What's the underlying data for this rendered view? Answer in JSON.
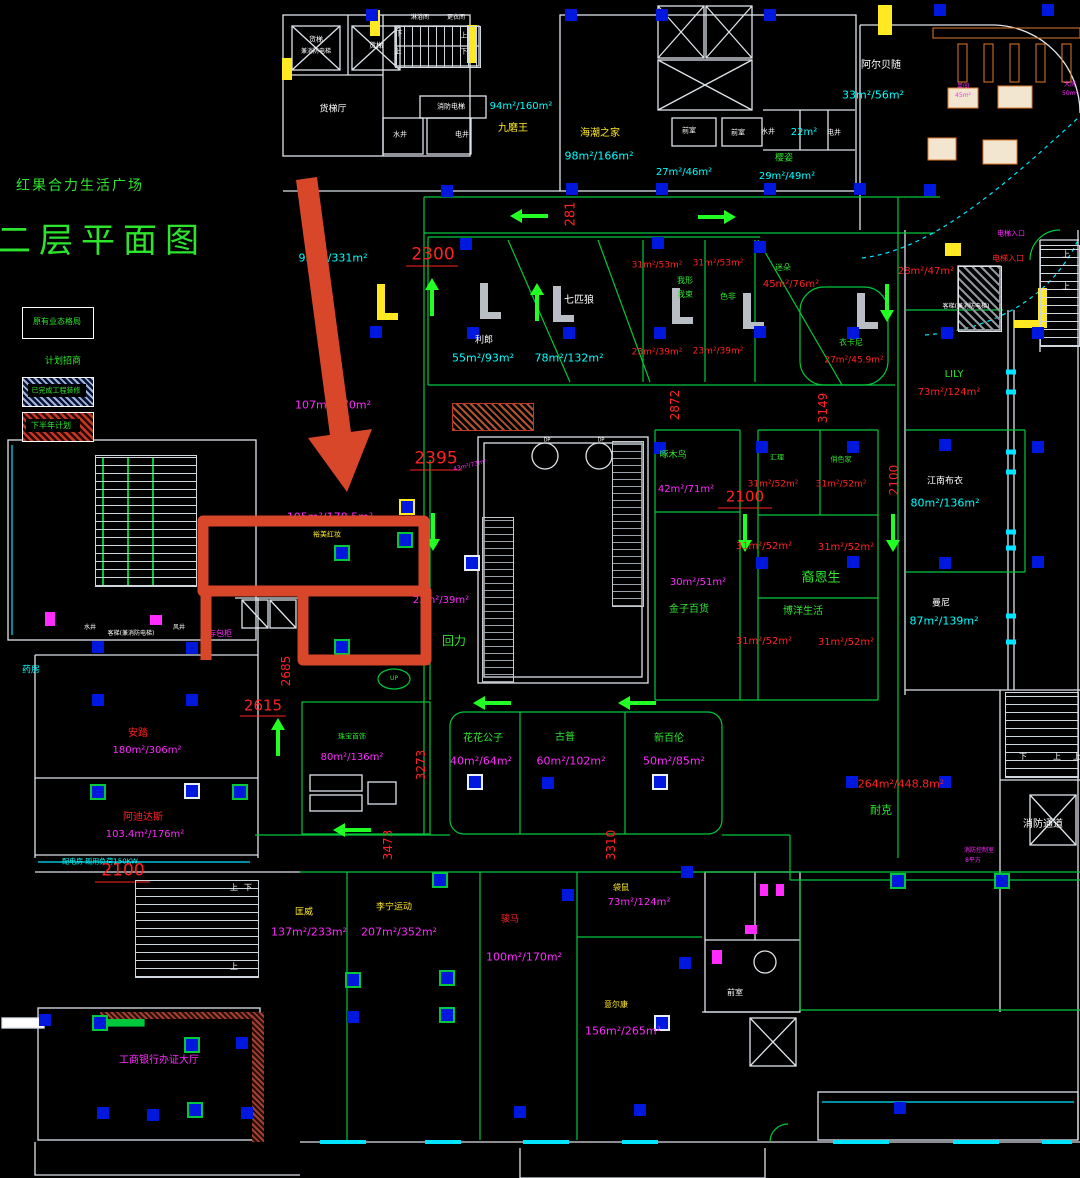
{
  "drawing": {
    "project_title": "红果合力生活广场",
    "sheet_title": "二层平面图"
  },
  "colors": {
    "g": "#2ee52e",
    "c": "#00ffff",
    "m": "#ff2bff",
    "r": "#ff2222",
    "y": "#ffe923",
    "w": "#ffffff",
    "o": "#e07a2e",
    "line_green": "#00c83c",
    "wall_white": "#dde4ea",
    "cyan_line": "#00e5ff",
    "blue_marker": "#0018dd",
    "annotation_red": "#d9472b",
    "legend_hatch_blue": "#9fb4dd",
    "legend_hatch_red": "#c23826"
  },
  "legend": {
    "existing_box_label": "原有业态格局",
    "note_label": "计划招商",
    "done_hatch_label": "已完成工程装修",
    "plan_hatch_label": "下半年计划"
  },
  "labels": [
    {
      "t": "红果合力生活广场",
      "x": 80,
      "y": 186,
      "c": "g",
      "s": 14,
      "ls": 2,
      "n": "project-title"
    },
    {
      "t": "二层平面图",
      "x": 102,
      "y": 241,
      "c": "g",
      "s": 34,
      "ls": 8,
      "n": "sheet-title"
    },
    {
      "t": "原有业态格局",
      "x": 57,
      "y": 322,
      "c": "g",
      "s": 8,
      "n": "legend-existing"
    },
    {
      "t": "计划招商",
      "x": 63,
      "y": 362,
      "c": "g",
      "s": 9,
      "n": "legend-note"
    },
    {
      "t": "已完成工程装修",
      "x": 56,
      "y": 391,
      "c": "g",
      "s": 7,
      "n": "legend-done"
    },
    {
      "t": "下半年计划",
      "x": 51,
      "y": 426,
      "c": "g",
      "s": 8,
      "n": "legend-plan"
    },
    {
      "t": "货梯",
      "x": 316,
      "y": 40,
      "c": "w",
      "s": 7,
      "n": "room"
    },
    {
      "t": "兼消防电梯",
      "x": 316,
      "y": 52,
      "c": "w",
      "s": 6,
      "n": "room"
    },
    {
      "t": "货梯",
      "x": 376,
      "y": 46,
      "c": "w",
      "s": 7,
      "n": "room"
    },
    {
      "t": "货梯厅",
      "x": 333,
      "y": 110,
      "c": "w",
      "s": 9,
      "n": "room"
    },
    {
      "t": "淋浴间",
      "x": 420,
      "y": 18,
      "c": "w",
      "s": 6,
      "n": "room"
    },
    {
      "t": "更衣间",
      "x": 456,
      "y": 18,
      "c": "w",
      "s": 6,
      "n": "room"
    },
    {
      "t": "下",
      "x": 399,
      "y": 34,
      "c": "w",
      "s": 7,
      "n": "stair-dir"
    },
    {
      "t": "上",
      "x": 464,
      "y": 36,
      "c": "w",
      "s": 7,
      "n": "stair-dir"
    },
    {
      "t": "上",
      "x": 398,
      "y": 52,
      "c": "w",
      "s": 7,
      "n": "stair-dir"
    },
    {
      "t": "下",
      "x": 464,
      "y": 52,
      "c": "w",
      "s": 7,
      "n": "stair-dir"
    },
    {
      "t": "消防电梯",
      "x": 451,
      "y": 107,
      "c": "w",
      "s": 7,
      "n": "room"
    },
    {
      "t": "水井",
      "x": 400,
      "y": 135,
      "c": "w",
      "s": 7,
      "n": "room"
    },
    {
      "t": "电井",
      "x": 462,
      "y": 135,
      "c": "w",
      "s": 7,
      "n": "room"
    },
    {
      "t": "94m²/160m²",
      "x": 521,
      "y": 107,
      "c": "c",
      "s": 10,
      "n": "area"
    },
    {
      "t": "九磨王",
      "x": 513,
      "y": 129,
      "c": "y",
      "s": 10,
      "n": "brand"
    },
    {
      "t": "海潮之家",
      "x": 600,
      "y": 134,
      "c": "y",
      "s": 10,
      "n": "brand"
    },
    {
      "t": "98m²/166m²",
      "x": 599,
      "y": 156,
      "c": "c",
      "s": 11,
      "n": "area"
    },
    {
      "t": "前室",
      "x": 689,
      "y": 131,
      "c": "w",
      "s": 7,
      "n": "room"
    },
    {
      "t": "前室",
      "x": 738,
      "y": 133,
      "c": "w",
      "s": 7,
      "n": "room"
    },
    {
      "t": "水井",
      "x": 768,
      "y": 132,
      "c": "w",
      "s": 7,
      "n": "room"
    },
    {
      "t": "22m²",
      "x": 804,
      "y": 133,
      "c": "c",
      "s": 10,
      "n": "area"
    },
    {
      "t": "电井",
      "x": 834,
      "y": 133,
      "c": "w",
      "s": 7,
      "n": "room"
    },
    {
      "t": "27m²/46m²",
      "x": 684,
      "y": 173,
      "c": "c",
      "s": 10,
      "n": "area"
    },
    {
      "t": "樱姿",
      "x": 784,
      "y": 159,
      "c": "g",
      "s": 9,
      "n": "brand"
    },
    {
      "t": "29m²/49m²",
      "x": 787,
      "y": 177,
      "c": "c",
      "s": 10,
      "n": "area"
    },
    {
      "t": "阿尔贝随",
      "x": 881,
      "y": 66,
      "c": "w",
      "s": 10,
      "n": "brand"
    },
    {
      "t": "33m²/56m²",
      "x": 873,
      "y": 95,
      "c": "c",
      "s": 11,
      "n": "area"
    },
    {
      "t": "单间",
      "x": 963,
      "y": 87,
      "c": "m",
      "s": 6,
      "n": "note"
    },
    {
      "t": "45m²",
      "x": 963,
      "y": 96,
      "c": "m",
      "s": 6,
      "n": "area"
    },
    {
      "t": "大房",
      "x": 1070,
      "y": 85,
      "c": "m",
      "s": 6,
      "n": "note"
    },
    {
      "t": "50m²",
      "x": 1070,
      "y": 94,
      "c": "m",
      "s": 6,
      "n": "area"
    },
    {
      "t": "2300",
      "x": 433,
      "y": 255,
      "c": "r",
      "s": 17,
      "n": "dim"
    },
    {
      "t": "281",
      "x": 571,
      "y": 214,
      "c": "r",
      "s": 13,
      "r": -90,
      "n": "dim"
    },
    {
      "t": "2395",
      "x": 436,
      "y": 459,
      "c": "r",
      "s": 17,
      "n": "dim"
    },
    {
      "t": "43m²/73m²",
      "x": 470,
      "y": 466,
      "c": "m",
      "s": 6,
      "r": -14,
      "n": "area"
    },
    {
      "t": "利郎",
      "x": 484,
      "y": 341,
      "c": "w",
      "s": 9,
      "n": "brand"
    },
    {
      "t": "55m²/93m²",
      "x": 483,
      "y": 358,
      "c": "c",
      "s": 11,
      "n": "area"
    },
    {
      "t": "七匹狼",
      "x": 579,
      "y": 301,
      "c": "w",
      "s": 10,
      "n": "brand"
    },
    {
      "t": "78m²/132m²",
      "x": 569,
      "y": 358,
      "c": "c",
      "s": 11,
      "n": "area"
    },
    {
      "t": "31m²/53m²",
      "x": 657,
      "y": 266,
      "c": "r",
      "s": 9,
      "n": "area"
    },
    {
      "t": "31m²/53m²",
      "x": 718,
      "y": 264,
      "c": "r",
      "s": 9,
      "n": "area"
    },
    {
      "t": "我形",
      "x": 685,
      "y": 281,
      "c": "g",
      "s": 8,
      "n": "brand"
    },
    {
      "t": "我束",
      "x": 685,
      "y": 295,
      "c": "g",
      "s": 8,
      "n": "brand"
    },
    {
      "t": "色非",
      "x": 728,
      "y": 297,
      "c": "g",
      "s": 8,
      "n": "brand"
    },
    {
      "t": "迷朵",
      "x": 783,
      "y": 268,
      "c": "g",
      "s": 8,
      "n": "brand"
    },
    {
      "t": "45m²/76m²",
      "x": 791,
      "y": 285,
      "c": "r",
      "s": 10,
      "n": "area"
    },
    {
      "t": "23m²/39m²",
      "x": 657,
      "y": 353,
      "c": "r",
      "s": 9,
      "n": "area"
    },
    {
      "t": "23m²/39m²",
      "x": 718,
      "y": 352,
      "c": "r",
      "s": 9,
      "n": "area"
    },
    {
      "t": "衣卡尼",
      "x": 851,
      "y": 343,
      "c": "g",
      "s": 8,
      "n": "brand"
    },
    {
      "t": "27m²/45.9m²",
      "x": 854,
      "y": 361,
      "c": "r",
      "s": 9,
      "n": "area"
    },
    {
      "t": "2872",
      "x": 675,
      "y": 405,
      "c": "r",
      "s": 12,
      "r": -90,
      "n": "dim"
    },
    {
      "t": "3149",
      "x": 823,
      "y": 408,
      "c": "r",
      "s": 12,
      "r": -90,
      "n": "dim"
    },
    {
      "t": "28m²/47m²",
      "x": 926,
      "y": 272,
      "c": "r",
      "s": 10,
      "n": "area"
    },
    {
      "t": "电梯入口",
      "x": 1011,
      "y": 234,
      "c": "m",
      "s": 7,
      "n": "note"
    },
    {
      "t": "电梯入口",
      "x": 1008,
      "y": 259,
      "c": "r",
      "s": 8,
      "n": "note"
    },
    {
      "t": "客梯(兼消防电梯)",
      "x": 966,
      "y": 307,
      "c": "w",
      "s": 6,
      "n": "room"
    },
    {
      "t": "LILY",
      "x": 954,
      "y": 375,
      "c": "g",
      "s": 10,
      "n": "brand"
    },
    {
      "t": "73m²/124m²",
      "x": 949,
      "y": 393,
      "c": "r",
      "s": 10,
      "n": "area"
    },
    {
      "t": "上",
      "x": 1066,
      "y": 255,
      "c": "w",
      "s": 8,
      "n": "stair-dir"
    },
    {
      "t": "上",
      "x": 1066,
      "y": 287,
      "c": "w",
      "s": 8,
      "n": "stair-dir"
    },
    {
      "t": "2100",
      "x": 894,
      "y": 480,
      "c": "r",
      "s": 12,
      "r": -90,
      "n": "dim"
    },
    {
      "t": "江南布衣",
      "x": 945,
      "y": 482,
      "c": "w",
      "s": 9,
      "n": "brand"
    },
    {
      "t": "80m²/136m²",
      "x": 945,
      "y": 503,
      "c": "c",
      "s": 11,
      "n": "area"
    },
    {
      "t": "曼尼",
      "x": 941,
      "y": 604,
      "c": "w",
      "s": 9,
      "n": "brand"
    },
    {
      "t": "87m²/139m²",
      "x": 944,
      "y": 621,
      "c": "c",
      "s": 11,
      "n": "area"
    },
    {
      "t": "105m²/178.5m²",
      "x": 330,
      "y": 517,
      "c": "m",
      "s": 11,
      "n": "area"
    },
    {
      "t": "裕美红妆",
      "x": 327,
      "y": 535,
      "c": "y",
      "s": 7,
      "n": "brand"
    },
    {
      "t": "23m²/39m²",
      "x": 441,
      "y": 601,
      "c": "m",
      "s": 10,
      "n": "area"
    },
    {
      "t": "回力",
      "x": 454,
      "y": 641,
      "c": "g",
      "s": 12,
      "n": "brand"
    },
    {
      "t": "95m²/331m²",
      "x": 333,
      "y": 258,
      "c": "c",
      "s": 11,
      "n": "area"
    },
    {
      "t": "107m²/170m²",
      "x": 333,
      "y": 405,
      "c": "m",
      "s": 11,
      "n": "area"
    },
    {
      "t": "DP",
      "x": 547,
      "y": 441,
      "c": "w",
      "s": 5,
      "n": "note"
    },
    {
      "t": "DP",
      "x": 601,
      "y": 441,
      "c": "w",
      "s": 5,
      "n": "note"
    },
    {
      "t": "啄木鸟",
      "x": 673,
      "y": 456,
      "c": "g",
      "s": 9,
      "n": "brand"
    },
    {
      "t": "42m²/71m²",
      "x": 686,
      "y": 490,
      "c": "m",
      "s": 10,
      "n": "area"
    },
    {
      "t": "2100",
      "x": 745,
      "y": 497,
      "c": "r",
      "s": 15,
      "n": "dim"
    },
    {
      "t": "汇理",
      "x": 777,
      "y": 458,
      "c": "g",
      "s": 7,
      "n": "brand"
    },
    {
      "t": "31m²/52m²",
      "x": 773,
      "y": 485,
      "c": "r",
      "s": 9,
      "n": "area"
    },
    {
      "t": "俏色家",
      "x": 841,
      "y": 460,
      "c": "g",
      "s": 7,
      "n": "brand"
    },
    {
      "t": "31m²/52m²",
      "x": 841,
      "y": 485,
      "c": "r",
      "s": 9,
      "n": "area"
    },
    {
      "t": "31m²/52m²",
      "x": 764,
      "y": 547,
      "c": "r",
      "s": 10,
      "n": "area"
    },
    {
      "t": "31m²/52m²",
      "x": 846,
      "y": 548,
      "c": "r",
      "s": 10,
      "n": "area"
    },
    {
      "t": "裔恩生",
      "x": 821,
      "y": 578,
      "c": "g",
      "s": 13,
      "n": "brand"
    },
    {
      "t": "博洋生活",
      "x": 803,
      "y": 612,
      "c": "g",
      "s": 10,
      "n": "brand"
    },
    {
      "t": "30m²/51m²",
      "x": 698,
      "y": 583,
      "c": "m",
      "s": 10,
      "n": "area"
    },
    {
      "t": "金子百货",
      "x": 689,
      "y": 610,
      "c": "g",
      "s": 10,
      "n": "brand"
    },
    {
      "t": "31m²/52m²",
      "x": 764,
      "y": 642,
      "c": "r",
      "s": 10,
      "n": "area"
    },
    {
      "t": "31m²/52m²",
      "x": 846,
      "y": 643,
      "c": "r",
      "s": 10,
      "n": "area"
    },
    {
      "t": "2685",
      "x": 286,
      "y": 671,
      "c": "r",
      "s": 12,
      "r": -90,
      "n": "dim"
    },
    {
      "t": "2615",
      "x": 263,
      "y": 706,
      "c": "r",
      "s": 15,
      "n": "dim"
    },
    {
      "t": "存包柜",
      "x": 220,
      "y": 634,
      "c": "m",
      "s": 8,
      "n": "room"
    },
    {
      "t": "水井",
      "x": 90,
      "y": 628,
      "c": "w",
      "s": 6,
      "n": "room"
    },
    {
      "t": "客梯(兼消防电梯)",
      "x": 131,
      "y": 634,
      "c": "w",
      "s": 6,
      "n": "room"
    },
    {
      "t": "风井",
      "x": 179,
      "y": 628,
      "c": "w",
      "s": 6,
      "n": "room"
    },
    {
      "t": "珠宝首饰",
      "x": 352,
      "y": 737,
      "c": "g",
      "s": 7,
      "n": "brand"
    },
    {
      "t": "80m²/136m²",
      "x": 352,
      "y": 758,
      "c": "m",
      "s": 10,
      "n": "area"
    },
    {
      "t": "花花公子",
      "x": 483,
      "y": 739,
      "c": "g",
      "s": 10,
      "n": "brand"
    },
    {
      "t": "40m²/64m²",
      "x": 481,
      "y": 761,
      "c": "m",
      "s": 11,
      "n": "area"
    },
    {
      "t": "古普",
      "x": 565,
      "y": 738,
      "c": "g",
      "s": 10,
      "n": "brand"
    },
    {
      "t": "60m²/102m²",
      "x": 571,
      "y": 761,
      "c": "m",
      "s": 11,
      "n": "area"
    },
    {
      "t": "新百伦",
      "x": 669,
      "y": 739,
      "c": "g",
      "s": 10,
      "n": "brand"
    },
    {
      "t": "50m²/85m²",
      "x": 674,
      "y": 761,
      "c": "m",
      "s": 11,
      "n": "area"
    },
    {
      "t": "3273",
      "x": 421,
      "y": 765,
      "c": "r",
      "s": 12,
      "r": -90,
      "n": "dim"
    },
    {
      "t": "3473",
      "x": 388,
      "y": 845,
      "c": "r",
      "s": 12,
      "r": -90,
      "n": "dim"
    },
    {
      "t": "3310",
      "x": 611,
      "y": 845,
      "c": "r",
      "s": 12,
      "r": -90,
      "n": "dim"
    },
    {
      "t": "安踏",
      "x": 138,
      "y": 734,
      "c": "r",
      "s": 10,
      "n": "brand"
    },
    {
      "t": "180m²/306m²",
      "x": 147,
      "y": 751,
      "c": "m",
      "s": 10,
      "n": "area"
    },
    {
      "t": "阿迪达斯",
      "x": 143,
      "y": 818,
      "c": "r",
      "s": 10,
      "n": "brand"
    },
    {
      "t": "103.4m²/176m²",
      "x": 145,
      "y": 835,
      "c": "m",
      "s": 10,
      "n": "area"
    },
    {
      "t": "药房",
      "x": 31,
      "y": 671,
      "c": "c",
      "s": 9,
      "n": "room"
    },
    {
      "t": "配电房 现用负荷150KW",
      "x": 100,
      "y": 862,
      "c": "c",
      "s": 7,
      "n": "room"
    },
    {
      "t": "2100",
      "x": 123,
      "y": 871,
      "c": "r",
      "s": 17,
      "n": "dim"
    },
    {
      "t": "耐克",
      "x": 881,
      "y": 810,
      "c": "g",
      "s": 11,
      "n": "brand"
    },
    {
      "t": "264m²/448.8m²",
      "x": 901,
      "y": 784,
      "c": "r",
      "s": 11,
      "n": "area"
    },
    {
      "t": "消防通道",
      "x": 1043,
      "y": 825,
      "c": "w",
      "s": 10,
      "n": "room"
    },
    {
      "t": "消防控制室",
      "x": 979,
      "y": 851,
      "c": "m",
      "s": 6,
      "n": "room"
    },
    {
      "t": "8平方",
      "x": 973,
      "y": 861,
      "c": "m",
      "s": 6,
      "n": "area"
    },
    {
      "t": "匡威",
      "x": 304,
      "y": 913,
      "c": "y",
      "s": 9,
      "n": "brand"
    },
    {
      "t": "137m²/233m²",
      "x": 309,
      "y": 932,
      "c": "m",
      "s": 11,
      "n": "area"
    },
    {
      "t": "李宁运动",
      "x": 394,
      "y": 908,
      "c": "y",
      "s": 9,
      "n": "brand"
    },
    {
      "t": "207m²/352m²",
      "x": 399,
      "y": 932,
      "c": "m",
      "s": 11,
      "n": "area"
    },
    {
      "t": "骏马",
      "x": 510,
      "y": 920,
      "c": "r",
      "s": 9,
      "n": "brand"
    },
    {
      "t": "100m²/170m²",
      "x": 524,
      "y": 957,
      "c": "m",
      "s": 11,
      "n": "area"
    },
    {
      "t": "袋鼠",
      "x": 621,
      "y": 888,
      "c": "y",
      "s": 8,
      "n": "brand"
    },
    {
      "t": "73m²/124m²",
      "x": 639,
      "y": 903,
      "c": "m",
      "s": 10,
      "n": "area"
    },
    {
      "t": "意尔康",
      "x": 616,
      "y": 1005,
      "c": "y",
      "s": 8,
      "n": "brand"
    },
    {
      "t": "156m²/265m²",
      "x": 623,
      "y": 1031,
      "c": "m",
      "s": 11,
      "n": "area"
    },
    {
      "t": "前室",
      "x": 735,
      "y": 993,
      "c": "w",
      "s": 8,
      "n": "room"
    },
    {
      "t": "工商银行办证大厅",
      "x": 159,
      "y": 1061,
      "c": "m",
      "s": 10,
      "n": "room"
    },
    {
      "t": "上",
      "x": 234,
      "y": 888,
      "c": "w",
      "s": 8,
      "n": "stair-dir"
    },
    {
      "t": "下",
      "x": 248,
      "y": 888,
      "c": "w",
      "s": 8,
      "n": "stair-dir"
    },
    {
      "t": "上",
      "x": 234,
      "y": 967,
      "c": "w",
      "s": 8,
      "n": "stair-dir"
    },
    {
      "t": "下",
      "x": 1023,
      "y": 757,
      "c": "w",
      "s": 8,
      "n": "stair-dir"
    },
    {
      "t": "上",
      "x": 1057,
      "y": 757,
      "c": "w",
      "s": 8,
      "n": "stair-dir"
    },
    {
      "t": "上",
      "x": 1077,
      "y": 757,
      "c": "w",
      "s": 8,
      "n": "stair-dir"
    },
    {
      "t": "UP",
      "x": 394,
      "y": 679,
      "c": "g",
      "s": 6,
      "n": "note"
    }
  ],
  "annotation": {
    "arrow_color": "#d9472b",
    "highlight_color": "#d9472b"
  }
}
